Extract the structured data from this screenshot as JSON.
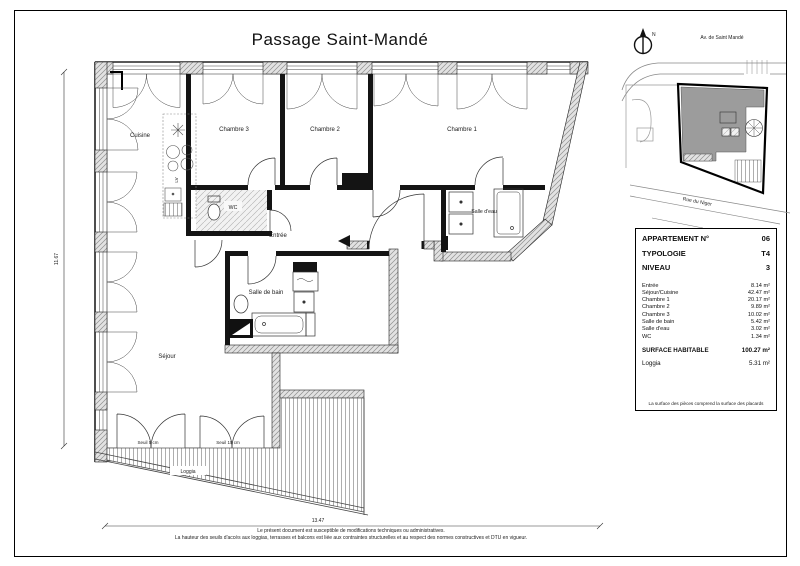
{
  "page": {
    "title": "Passage Saint-Mandé",
    "disclaimer_line1": "Le présent document est susceptible de modifications techniques ou administratives.",
    "disclaimer_line2": "La hauteur des seuils d'accès aux loggias, terrasses et balcons est liée aux contraintes structurelles et au respect des normes constructives et DTU en vigueur."
  },
  "plan": {
    "rooms": {
      "cuisine": "Cuisine",
      "chambre3": "Chambre 3",
      "chambre2": "Chambre 2",
      "chambre1": "Chambre 1",
      "entree": "Entrée",
      "salle_de_bain": "Salle de bain",
      "salle_deau": "Salle d'eau",
      "wc": "WC",
      "sejour": "Séjour",
      "loggia": "Loggia"
    },
    "annotations": {
      "seuil_5": "Seuil 5 cm",
      "seuil_15": "Seuil 15 cm",
      "lv": "LV"
    },
    "dimensions": {
      "height": "11.67",
      "width": "13.47"
    }
  },
  "site_map": {
    "north_label": "N",
    "street_top": "Av. de Saint Mandé",
    "street_bottom": "Rue du Niger",
    "highlight_color": "#9c9c9c"
  },
  "info_panel": {
    "header": [
      {
        "label": "APPARTEMENT N°",
        "value": "06"
      },
      {
        "label": "TYPOLOGIE",
        "value": "T4"
      },
      {
        "label": "NIVEAU",
        "value": "3"
      }
    ],
    "rooms": [
      {
        "label": "Entrée",
        "value": "8.14 m²"
      },
      {
        "label": "Séjour/Cuisine",
        "value": "42.47 m²"
      },
      {
        "label": "Chambre 1",
        "value": "20.17 m²"
      },
      {
        "label": "Chambre 2",
        "value": "9.89 m²"
      },
      {
        "label": "Chambre 3",
        "value": "10.02 m²"
      },
      {
        "label": "Salle de bain",
        "value": "5.42 m²"
      },
      {
        "label": "Salle d'eau",
        "value": "3.02 m²"
      },
      {
        "label": "WC",
        "value": "1.34 m²"
      }
    ],
    "total": {
      "label": "SURFACE HABITABLE",
      "value": "100.27 m²"
    },
    "loggia": {
      "label": "Loggia",
      "value": "5.31 m²"
    },
    "footnote": "La surface des pièces comprend la surface des placards"
  }
}
